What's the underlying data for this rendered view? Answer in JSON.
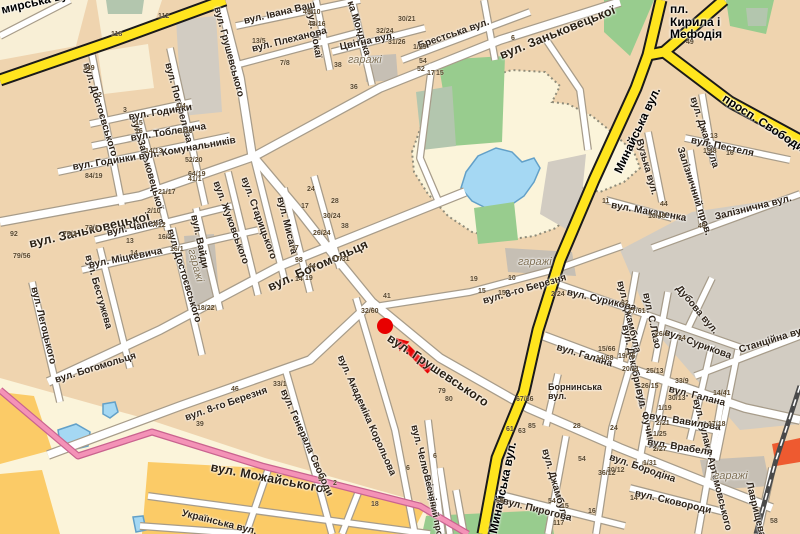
{
  "map": {
    "kind": "city-street-map",
    "colors": {
      "bg": "#EFD4AF",
      "street": "#FFFFFF",
      "casing": "#A79C8A",
      "yellow": "#FFE51E",
      "yellow_casing": "#1A1A1A",
      "pink": "#F492B7",
      "pink_casing": "#C9638F",
      "cream": "#FBF4DA",
      "cream2": "#F8EFD6",
      "orange": "#FBCB67",
      "green": "#98CC8E",
      "greengray": "#B3C6AE",
      "gray": "#D2CCC2",
      "gray2": "#C6BFB4",
      "water": "#A5D8F3",
      "waterline": "#62A0C8",
      "rail": "#4A4A4A",
      "hatch": "#8F8C7A",
      "redbldg": "#EE5A30",
      "marker": "#E80000"
    },
    "marker": {
      "dot": {
        "x": 385,
        "y": 326,
        "r": 8
      },
      "arrow": {
        "x1": 430,
        "y1": 371,
        "x2": 406,
        "y2": 347
      },
      "color": "#E80000"
    }
  },
  "labels": {
    "streets": [
      {
        "t": "мирська вул.",
        "x": 0,
        "y": 4,
        "r": -13,
        "c": "road"
      },
      {
        "t": "Минайська вул.",
        "x": 612,
        "y": 170,
        "r": -65,
        "c": "road"
      },
      {
        "t": "Минайська вул.",
        "x": 487,
        "y": 532,
        "r": -78,
        "c": "road"
      },
      {
        "t": "просп. Свободи",
        "x": 727,
        "y": 92,
        "r": 33,
        "c": "road"
      },
      {
        "t": "пл.\nКирила і\nМефодія",
        "x": 670,
        "y": 3,
        "r": 0,
        "c": "road"
      },
      {
        "t": "вул. Заньковецької",
        "x": 28,
        "y": 238,
        "r": -13,
        "c": "major"
      },
      {
        "t": "вул. Заньковецької",
        "x": 498,
        "y": 50,
        "r": -22,
        "c": "major"
      },
      {
        "t": "вул. Богомольця",
        "x": 266,
        "y": 282,
        "r": -24,
        "c": "major"
      },
      {
        "t": "вул. Богомольця",
        "x": 54,
        "y": 376,
        "r": -17,
        "c": "street"
      },
      {
        "t": "вул. Грушевського",
        "x": 392,
        "y": 332,
        "r": 34,
        "c": "major"
      },
      {
        "t": "вул. Можайського",
        "x": 212,
        "y": 461,
        "r": 11,
        "c": "major"
      },
      {
        "t": "вул. 8-го Березня",
        "x": 184,
        "y": 414,
        "r": -19,
        "c": "street"
      },
      {
        "t": "вул. 8-го Березня",
        "x": 482,
        "y": 297,
        "r": -16,
        "c": "street"
      },
      {
        "t": "Українська вул.",
        "x": 183,
        "y": 509,
        "r": 14,
        "c": "street"
      },
      {
        "t": "вул. Грушевського",
        "x": 221,
        "y": 6,
        "r": 75,
        "c": "street"
      },
      {
        "t": "вул. Погорелова",
        "x": 172,
        "y": 62,
        "r": 75,
        "c": "street"
      },
      {
        "t": "вул. Достоєвського",
        "x": 90,
        "y": 62,
        "r": 73,
        "c": "street"
      },
      {
        "t": "вул. Заньковецької",
        "x": 138,
        "y": 116,
        "r": 74,
        "c": "street"
      },
      {
        "t": "вул. Жуковського",
        "x": 220,
        "y": 180,
        "r": 70,
        "c": "street"
      },
      {
        "t": "вул. Старицького",
        "x": 248,
        "y": 176,
        "r": 70,
        "c": "street"
      },
      {
        "t": "вул. Вайди",
        "x": 198,
        "y": 214,
        "r": 78,
        "c": "street"
      },
      {
        "t": "вул. Достоєвського",
        "x": 174,
        "y": 228,
        "r": 73,
        "c": "street"
      },
      {
        "t": "вул. Бестужева",
        "x": 92,
        "y": 254,
        "r": 74,
        "c": "street"
      },
      {
        "t": "вул. Легоцького",
        "x": 38,
        "y": 286,
        "r": 76,
        "c": "street"
      },
      {
        "t": "вул. Мисага",
        "x": 284,
        "y": 196,
        "r": 76,
        "c": "street"
      },
      {
        "t": "вул. Йокаї",
        "x": 314,
        "y": 8,
        "r": 80,
        "c": "street"
      },
      {
        "t": "ка Мондока",
        "x": 354,
        "y": 0,
        "r": 72,
        "c": "street"
      },
      {
        "t": "вул. Академіка Корольова",
        "x": 344,
        "y": 354,
        "r": 66,
        "c": "street"
      },
      {
        "t": "вул. Генерала Свободи",
        "x": 287,
        "y": 388,
        "r": 66,
        "c": "street"
      },
      {
        "t": "вул. Челюскінців",
        "x": 418,
        "y": 424,
        "r": 76,
        "c": "street"
      },
      {
        "t": "Весняний пров.",
        "x": 431,
        "y": 474,
        "r": 78,
        "c": "small"
      },
      {
        "t": "вул. Джамбула",
        "x": 549,
        "y": 448,
        "r": 74,
        "c": "street"
      },
      {
        "t": "вул. Джамбула",
        "x": 624,
        "y": 280,
        "r": 76,
        "c": "street"
      },
      {
        "t": "вул. Джамбула",
        "x": 697,
        "y": 96,
        "r": 72,
        "c": "street"
      },
      {
        "t": "вул. Декабристів",
        "x": 629,
        "y": 324,
        "r": 78,
        "c": "street"
      },
      {
        "t": "вул. С.Лазо",
        "x": 650,
        "y": 292,
        "r": 78,
        "c": "street"
      },
      {
        "t": "вул. Фучика",
        "x": 643,
        "y": 388,
        "r": 77,
        "c": "street"
      },
      {
        "t": "вул. Гулака-Артемовського",
        "x": 700,
        "y": 398,
        "r": 76,
        "c": "street"
      },
      {
        "t": "Лаврищева",
        "x": 753,
        "y": 481,
        "r": 76,
        "c": "street"
      },
      {
        "t": "Вузька вул.",
        "x": 643,
        "y": 138,
        "r": 74,
        "c": "street"
      },
      {
        "t": "Залізничний пров.",
        "x": 684,
        "y": 146,
        "r": 72,
        "c": "street"
      },
      {
        "t": "вул. Івана Ваш",
        "x": 243,
        "y": 17,
        "r": -13,
        "c": "street"
      },
      {
        "t": "вул. Плеханова",
        "x": 251,
        "y": 45,
        "r": -14,
        "c": "street"
      },
      {
        "t": "Цвітна вул.",
        "x": 339,
        "y": 43,
        "r": -12,
        "c": "street"
      },
      {
        "t": "Брестська вул.",
        "x": 417,
        "y": 42,
        "r": -19,
        "c": "street"
      },
      {
        "t": "вул. Годинки",
        "x": 128,
        "y": 113,
        "r": -9,
        "c": "street"
      },
      {
        "t": "вул. Тоблевича",
        "x": 130,
        "y": 134,
        "r": -9,
        "c": "street"
      },
      {
        "t": "вул. Годинки",
        "x": 72,
        "y": 163,
        "r": -9,
        "c": "street"
      },
      {
        "t": "вул. Комунальників",
        "x": 138,
        "y": 153,
        "r": -10,
        "c": "street"
      },
      {
        "t": "вул. Чапека",
        "x": 106,
        "y": 229,
        "r": -12,
        "c": "street"
      },
      {
        "t": "вул. Міцкевича",
        "x": 88,
        "y": 261,
        "r": -11,
        "c": "street"
      },
      {
        "t": "вул. Макаренка",
        "x": 612,
        "y": 201,
        "r": 10,
        "c": "street"
      },
      {
        "t": "вул. Пестеля",
        "x": 692,
        "y": 136,
        "r": 12,
        "c": "street"
      },
      {
        "t": "Залізнична вул.",
        "x": 714,
        "y": 213,
        "r": -14,
        "c": "street"
      },
      {
        "t": "Станційна вул.",
        "x": 738,
        "y": 346,
        "r": -17,
        "c": "street"
      },
      {
        "t": "Дубова вул.",
        "x": 681,
        "y": 284,
        "r": 50,
        "c": "street"
      },
      {
        "t": "вул. Сурикова",
        "x": 568,
        "y": 288,
        "r": 13,
        "c": "street"
      },
      {
        "t": "вул. Сурикова",
        "x": 666,
        "y": 328,
        "r": 20,
        "c": "street"
      },
      {
        "t": "вул. Галана",
        "x": 558,
        "y": 343,
        "r": 17,
        "c": "street"
      },
      {
        "t": "вул. Галана",
        "x": 670,
        "y": 385,
        "r": 14,
        "c": "street"
      },
      {
        "t": "вул. Пирогова",
        "x": 504,
        "y": 497,
        "r": 14,
        "c": "street"
      },
      {
        "t": "вул. Вавилова",
        "x": 650,
        "y": 412,
        "r": 9,
        "c": "street"
      },
      {
        "t": "вул. Врабеля",
        "x": 648,
        "y": 438,
        "r": 9,
        "c": "street"
      },
      {
        "t": "вул. Бородіна",
        "x": 611,
        "y": 453,
        "r": 19,
        "c": "street"
      },
      {
        "t": "вул. Сковороди",
        "x": 636,
        "y": 489,
        "r": 13,
        "c": "street"
      },
      {
        "t": "Борнинська\nвул.",
        "x": 548,
        "y": 383,
        "r": 0,
        "c": "small"
      },
      {
        "t": "гаражі",
        "x": 348,
        "y": 55,
        "r": 0,
        "c": "area"
      },
      {
        "t": "гаражі",
        "x": 518,
        "y": 257,
        "r": 0,
        "c": "area"
      },
      {
        "t": "гаражі",
        "x": 714,
        "y": 471,
        "r": 0,
        "c": "area"
      },
      {
        "t": "гаражі",
        "x": 196,
        "y": 248,
        "r": 75,
        "c": "area"
      }
    ],
    "numbers": [
      [
        158,
        13,
        "112"
      ],
      [
        111,
        31,
        "118"
      ],
      [
        83,
        65,
        "149"
      ],
      [
        98,
        92,
        "2"
      ],
      [
        123,
        107,
        "3"
      ],
      [
        135,
        120,
        "15"
      ],
      [
        135,
        128,
        "16"
      ],
      [
        176,
        103,
        "1/4"
      ],
      [
        179,
        128,
        "1/10"
      ],
      [
        145,
        148,
        "14/13"
      ],
      [
        185,
        157,
        "52/20"
      ],
      [
        188,
        171,
        "64/19"
      ],
      [
        303,
        9,
        "49/10"
      ],
      [
        308,
        21,
        "48/16"
      ],
      [
        280,
        60,
        "7/8"
      ],
      [
        398,
        16,
        "30/21"
      ],
      [
        376,
        28,
        "32/24"
      ],
      [
        388,
        39,
        "31/26"
      ],
      [
        413,
        44,
        "1/29"
      ],
      [
        334,
        62,
        "38"
      ],
      [
        350,
        84,
        "36"
      ],
      [
        252,
        38,
        "13/5"
      ],
      [
        427,
        70,
        "17"
      ],
      [
        436,
        70,
        "15"
      ],
      [
        511,
        35,
        "6"
      ],
      [
        686,
        39,
        "49"
      ],
      [
        85,
        173,
        "84/19"
      ],
      [
        188,
        176,
        "41/1"
      ],
      [
        158,
        189,
        "21/17"
      ],
      [
        147,
        208,
        "2/10"
      ],
      [
        152,
        222,
        "7/12"
      ],
      [
        85,
        225,
        "73/1"
      ],
      [
        63,
        231,
        "75/2"
      ],
      [
        13,
        253,
        "79/56"
      ],
      [
        10,
        231,
        "92"
      ],
      [
        126,
        238,
        "13"
      ],
      [
        130,
        250,
        "14"
      ],
      [
        158,
        234,
        "16/2"
      ],
      [
        170,
        246,
        "16/1"
      ],
      [
        197,
        305,
        "18/22"
      ],
      [
        295,
        276,
        "14"
      ],
      [
        307,
        186,
        "24"
      ],
      [
        301,
        203,
        "17"
      ],
      [
        313,
        230,
        "26/24"
      ],
      [
        291,
        245,
        "37"
      ],
      [
        295,
        257,
        "98"
      ],
      [
        308,
        263,
        "44"
      ],
      [
        305,
        275,
        "19"
      ],
      [
        332,
        256,
        "17/31"
      ],
      [
        331,
        198,
        "28"
      ],
      [
        323,
        213,
        "30/24"
      ],
      [
        341,
        223,
        "38"
      ],
      [
        383,
        293,
        "41"
      ],
      [
        361,
        308,
        "32/60"
      ],
      [
        438,
        388,
        "79"
      ],
      [
        445,
        396,
        "80"
      ],
      [
        516,
        396,
        "67/36"
      ],
      [
        498,
        290,
        "15"
      ],
      [
        470,
        276,
        "19"
      ],
      [
        478,
        288,
        "15"
      ],
      [
        508,
        275,
        "10"
      ],
      [
        551,
        291,
        "2/24"
      ],
      [
        621,
        300,
        "82"
      ],
      [
        628,
        308,
        "17/61"
      ],
      [
        598,
        346,
        "15/66"
      ],
      [
        596,
        355,
        "14/68"
      ],
      [
        618,
        353,
        "19/75"
      ],
      [
        622,
        366,
        "20/11"
      ],
      [
        602,
        198,
        "11"
      ],
      [
        660,
        201,
        "44"
      ],
      [
        648,
        213,
        "10/48"
      ],
      [
        710,
        133,
        "13"
      ],
      [
        703,
        148,
        "15/8"
      ],
      [
        726,
        150,
        "16"
      ],
      [
        698,
        223,
        "40"
      ],
      [
        655,
        331,
        "26/1"
      ],
      [
        678,
        335,
        "34"
      ],
      [
        646,
        368,
        "25/13"
      ],
      [
        675,
        378,
        "33/9"
      ],
      [
        641,
        383,
        "26/15"
      ],
      [
        668,
        395,
        "30/13"
      ],
      [
        713,
        390,
        "14/41"
      ],
      [
        658,
        405,
        "1/19"
      ],
      [
        656,
        420,
        "2/21"
      ],
      [
        708,
        421,
        "17/18"
      ],
      [
        653,
        431,
        "1/25"
      ],
      [
        653,
        446,
        "2/27"
      ],
      [
        643,
        460,
        "1/31"
      ],
      [
        607,
        467,
        "30/12"
      ],
      [
        630,
        495,
        "14"
      ],
      [
        770,
        518,
        "58"
      ],
      [
        610,
        425,
        "24"
      ],
      [
        506,
        426,
        "61"
      ],
      [
        518,
        428,
        "63"
      ],
      [
        573,
        423,
        "28"
      ],
      [
        433,
        453,
        "6"
      ],
      [
        496,
        498,
        "69"
      ],
      [
        548,
        498,
        "54"
      ],
      [
        561,
        503,
        "15"
      ],
      [
        553,
        520,
        "117"
      ],
      [
        588,
        508,
        "16"
      ],
      [
        598,
        470,
        "36/12"
      ],
      [
        578,
        456,
        "54"
      ],
      [
        196,
        421,
        "39"
      ],
      [
        231,
        386,
        "46"
      ],
      [
        273,
        381,
        "33/1"
      ],
      [
        318,
        476,
        "9"
      ],
      [
        333,
        480,
        "2"
      ],
      [
        406,
        465,
        "6"
      ],
      [
        371,
        501,
        "18"
      ],
      [
        528,
        423,
        "85"
      ],
      [
        419,
        58,
        "54"
      ],
      [
        417,
        66,
        "52"
      ]
    ]
  }
}
